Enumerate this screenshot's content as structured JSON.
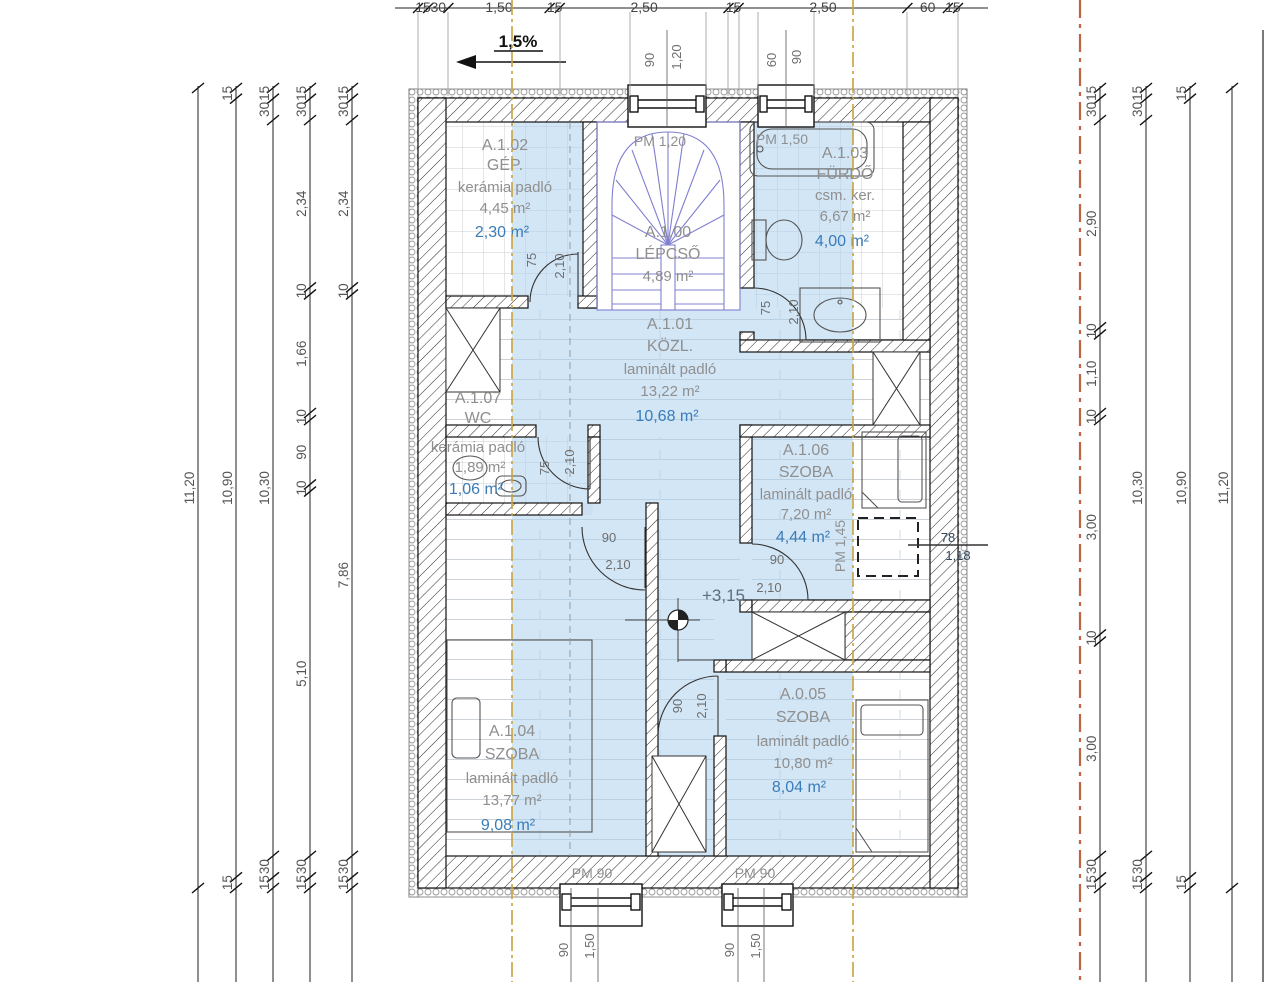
{
  "slope_label": "1,5%",
  "level_label": "+3,15",
  "watermark": "GDN",
  "rooms": [
    {
      "id": "A.1.02",
      "name": "GÉP.",
      "floor": "kerámia padló",
      "area": "4,45 m²",
      "area_reduced": "2,30 m²"
    },
    {
      "id": "A.1.00",
      "name": "LÉPCSŐ",
      "floor": "",
      "area": "4,89 m²",
      "area_reduced": ""
    },
    {
      "id": "A.1.03",
      "name": "FÜRDŐ",
      "floor": "csm. ker.",
      "area": "6,67 m²",
      "area_reduced": "4,00 m²"
    },
    {
      "id": "A.1.01",
      "name": "KÖZL.",
      "floor": "laminált padló",
      "area": "13,22 m²",
      "area_reduced": "10,68 m²"
    },
    {
      "id": "A.1.07",
      "name": "WC",
      "floor": "kerámia padló",
      "area": "1,89 m²",
      "area_reduced": "1,06 m²"
    },
    {
      "id": "A.1.06",
      "name": "SZOBA",
      "floor": "laminált padló",
      "area": "7,20 m²",
      "area_reduced": "4,44 m²"
    },
    {
      "id": "A.1.04",
      "name": "SZOBA",
      "floor": "laminált padló",
      "area": "13,77 m²",
      "area_reduced": "9,08 m²"
    },
    {
      "id": "A.0.05",
      "name": "SZOBA",
      "floor": "laminált padló",
      "area": "10,80 m²",
      "area_reduced": "8,04 m²"
    }
  ],
  "openings": {
    "top_window_1": {
      "pm": "PM 1,20",
      "dims": [
        "90",
        "1,20"
      ]
    },
    "top_window_2": {
      "pm": "PM 1,50",
      "dims": [
        "60",
        "90"
      ]
    },
    "bottom_window_1": {
      "pm": "PM 90",
      "dims": [
        "90",
        "1,50"
      ]
    },
    "bottom_window_2": {
      "pm": "PM 90",
      "dims": [
        "90",
        "1,50"
      ]
    },
    "planned_window": {
      "pm": "PM 1,45",
      "dims": [
        "78",
        "1,18"
      ]
    }
  },
  "doors": [
    {
      "room": "A.1.02",
      "w": "75",
      "h": "2,10"
    },
    {
      "room": "A.1.07",
      "w": "75",
      "h": "2,10"
    },
    {
      "room": "A.1.03",
      "w": "75",
      "h": "2,10"
    },
    {
      "room": "A.1.04",
      "w": "90",
      "h": "2,10"
    },
    {
      "room": "A.1.06",
      "w": "90",
      "h": "2,10"
    },
    {
      "room": "A.0.05",
      "w": "90",
      "h": "2,10"
    }
  ],
  "dimensions": {
    "top": [
      "15",
      "30",
      "1,50",
      "15",
      "2,50",
      "15",
      "2,50",
      "60",
      "15"
    ],
    "left": [
      [
        "11,20"
      ],
      [
        "15",
        "10,90",
        "15"
      ],
      [
        "15",
        "30",
        "10,30",
        "30",
        "15"
      ],
      [
        "15",
        "30",
        "2,34",
        "10",
        "1,66",
        "10",
        "90",
        "10",
        "5,10",
        "30",
        "15"
      ],
      [
        "15",
        "30",
        "2,34",
        "10",
        "7,86",
        "30",
        "15"
      ]
    ],
    "right": [
      [
        "15",
        "30",
        "2,90",
        "10",
        "1,10",
        "10",
        "3,00",
        "10",
        "3,00",
        "30",
        "15"
      ],
      [
        "15",
        "30",
        "10,30",
        "30",
        "15"
      ],
      [
        "15",
        "10,90",
        "15"
      ],
      [
        "11,20"
      ]
    ]
  },
  "colors": {
    "highlight": "#a8cdee",
    "section_line": "#c9a43f",
    "axis_line": "#b5552d",
    "stair": "#8080d0",
    "reduced_area_text": "#3a7cb8",
    "room_text": "#8f8f8f",
    "dim_text": "#666666"
  }
}
